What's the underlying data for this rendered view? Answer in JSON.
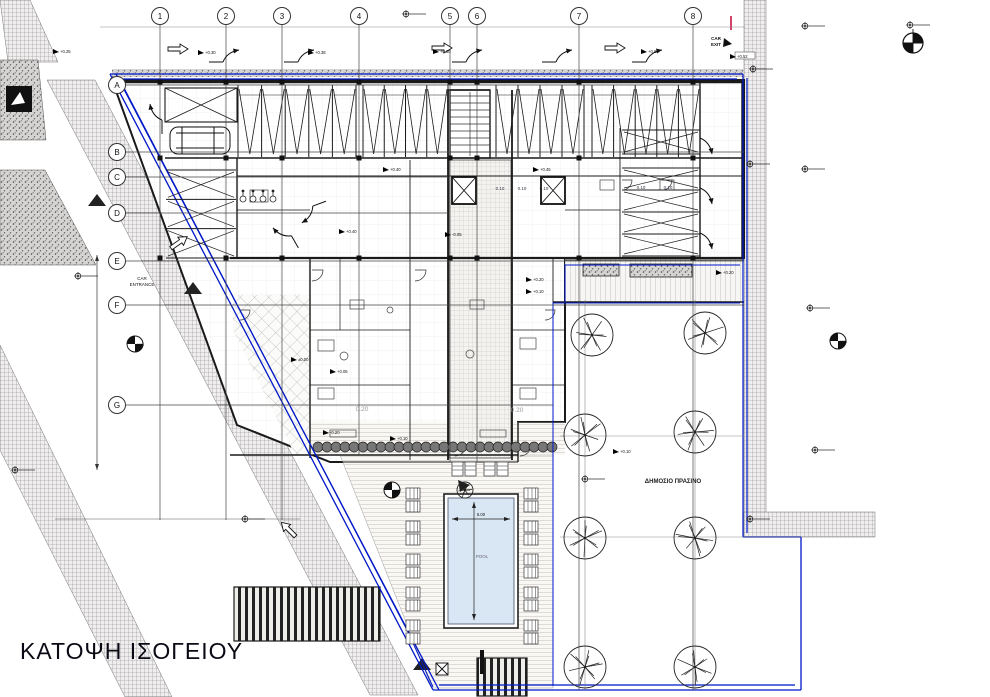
{
  "title": "ΚΑΤΟΨΗ ΙΣΟΓΕΙΟΥ",
  "colors": {
    "boundary_blue": "#0018c8",
    "line_black": "#1a1a1a",
    "pool_fill": "#d9e6f3",
    "accent_red": "#cc1144",
    "hatch_gray": "#8a8a8a"
  },
  "grid": {
    "columns": [
      {
        "label": "1",
        "x": 160,
        "y2": 520
      },
      {
        "label": "2",
        "x": 226,
        "y2": 520
      },
      {
        "label": "3",
        "x": 282,
        "y2": 520
      },
      {
        "label": "4",
        "x": 359,
        "y2": 455
      },
      {
        "label": "5",
        "x": 450,
        "y2": 462
      },
      {
        "label": "6",
        "x": 477,
        "y2": 462
      },
      {
        "label": "7",
        "x": 579,
        "y2": 690
      },
      {
        "label": "8",
        "x": 693,
        "y2": 690
      }
    ],
    "rows": [
      {
        "label": "A",
        "y": 85,
        "x2": 700
      },
      {
        "label": "B",
        "y": 152,
        "x2": 744
      },
      {
        "label": "C",
        "y": 177,
        "x2": 448
      },
      {
        "label": "D",
        "y": 213,
        "x2": 448
      },
      {
        "label": "E",
        "y": 261,
        "x2": 744
      },
      {
        "label": "F",
        "y": 305,
        "x2": 744
      },
      {
        "label": "G",
        "y": 405,
        "x2": 553
      }
    ]
  },
  "labels": {
    "car_exit": [
      "CAR",
      "EXIT"
    ],
    "car_entrance": [
      "CAR",
      "ENTRANCE"
    ],
    "public_green": "ΔΗΜΟΣΙΟ ΠΡΑΣΙΝΟ",
    "pool": "POOL",
    "pool_width_dim": "5.00"
  },
  "annotations": {
    "elevations": [
      {
        "x": 60,
        "y": 52,
        "t": "+0.25"
      },
      {
        "x": 205,
        "y": 53,
        "t": "+0.30"
      },
      {
        "x": 315,
        "y": 53,
        "t": "+0.38"
      },
      {
        "x": 440,
        "y": 52,
        "t": "+0.60"
      },
      {
        "x": 648,
        "y": 52,
        "t": "+0.60"
      },
      {
        "x": 737,
        "y": 57,
        "t": "+0.52"
      },
      {
        "x": 540,
        "y": 170,
        "t": "+0.45"
      },
      {
        "x": 390,
        "y": 170,
        "t": "+0.40"
      },
      {
        "x": 346,
        "y": 232,
        "t": "+0.40"
      },
      {
        "x": 452,
        "y": 235,
        "t": "-0.05"
      },
      {
        "x": 298,
        "y": 360,
        "t": "±0.00"
      },
      {
        "x": 337,
        "y": 372,
        "t": "+0.05"
      },
      {
        "x": 533,
        "y": 280,
        "t": "+0.20"
      },
      {
        "x": 533,
        "y": 292,
        "t": "+0.10"
      },
      {
        "x": 723,
        "y": 273,
        "t": "+0.20"
      },
      {
        "x": 330,
        "y": 433,
        "t": "-0.20"
      },
      {
        "x": 397,
        "y": 439,
        "t": "+0.10"
      },
      {
        "x": 620,
        "y": 452,
        "t": "+0.10"
      }
    ],
    "rooms": [
      {
        "x": 500,
        "y": 190,
        "t": "0.10"
      },
      {
        "x": 522,
        "y": 190,
        "t": "0.10"
      },
      {
        "x": 544,
        "y": 190,
        "t": "0.10"
      },
      {
        "x": 641,
        "y": 189,
        "t": "0.10"
      },
      {
        "x": 668,
        "y": 189,
        "t": "0.10"
      }
    ],
    "area_marks": [
      {
        "x": 362,
        "y": 411,
        "t": "0.20"
      },
      {
        "x": 517,
        "y": 412,
        "t": "0.20"
      }
    ],
    "benchmarks": [
      {
        "x": 135,
        "y": 344,
        "t": "A108"
      },
      {
        "x": 392,
        "y": 490,
        "t": "A107"
      },
      {
        "x": 838,
        "y": 341,
        "t": "A105"
      }
    ]
  },
  "site": {
    "trees_large": [
      [
        592,
        335
      ],
      [
        705,
        333
      ],
      [
        585,
        435
      ],
      [
        695,
        432
      ],
      [
        585,
        538
      ],
      [
        695,
        538
      ],
      [
        585,
        667
      ],
      [
        695,
        667
      ]
    ],
    "trees_small": [
      [
        465,
        490
      ]
    ],
    "tree_lines": [
      [
        585,
        300,
        585,
        690
      ],
      [
        695,
        300,
        695,
        690
      ]
    ],
    "loungers": {
      "left_x": 406,
      "right_x": 524,
      "pair_ys": [
        488,
        521,
        554,
        587,
        620
      ],
      "top_row": [
        [
          452,
          462
        ],
        [
          484,
          462
        ]
      ]
    }
  },
  "parking": {
    "vertical_groups": [
      {
        "x": 238,
        "y": 85,
        "w": 118,
        "h": 72,
        "n": 5
      },
      {
        "x": 363,
        "y": 85,
        "w": 85,
        "h": 72,
        "n": 4
      },
      {
        "x": 496,
        "y": 85,
        "w": 88,
        "h": 72,
        "n": 4
      },
      {
        "x": 592,
        "y": 85,
        "w": 108,
        "h": 72,
        "n": 5
      }
    ],
    "horizontal_groups": [
      {
        "x": 622,
        "y": 130,
        "w": 78,
        "h": 24,
        "n": 1
      },
      {
        "x": 622,
        "y": 168,
        "w": 78,
        "h": 88,
        "n": 4
      },
      {
        "x": 166,
        "y": 170,
        "w": 70,
        "h": 88,
        "n": 3
      }
    ],
    "x_stall": {
      "x": 165,
      "y": 88,
      "w": 72,
      "h": 34
    }
  },
  "symbols": {
    "crosshairs": [
      [
        406,
        14
      ],
      [
        910,
        25
      ],
      [
        805,
        26
      ],
      [
        753,
        69
      ],
      [
        750,
        164
      ],
      [
        805,
        169
      ],
      [
        78,
        276
      ],
      [
        810,
        308
      ],
      [
        815,
        450
      ],
      [
        15,
        470
      ],
      [
        245,
        519
      ],
      [
        585,
        479
      ],
      [
        750,
        519
      ]
    ],
    "open_arrows": [
      [
        168,
        44,
        0
      ],
      [
        432,
        43,
        0
      ],
      [
        605,
        43,
        0
      ],
      [
        168,
        244,
        -35
      ],
      [
        292,
        540,
        -135
      ]
    ],
    "curved_arrows": [
      [
        225,
        50,
        0
      ],
      [
        300,
        50,
        0
      ],
      [
        468,
        50,
        0
      ],
      [
        558,
        50,
        0
      ],
      [
        648,
        50,
        0
      ],
      [
        712,
        140,
        90
      ],
      [
        712,
        190,
        90
      ],
      [
        712,
        235,
        90
      ],
      [
        280,
        240,
        -120
      ],
      [
        315,
        218,
        160
      ],
      [
        150,
        118,
        -90
      ]
    ],
    "huts": [
      [
        97,
        200
      ],
      [
        193,
        288
      ],
      [
        422,
        664
      ]
    ],
    "north_arrow": {
      "x": 913,
      "y": 43
    }
  }
}
